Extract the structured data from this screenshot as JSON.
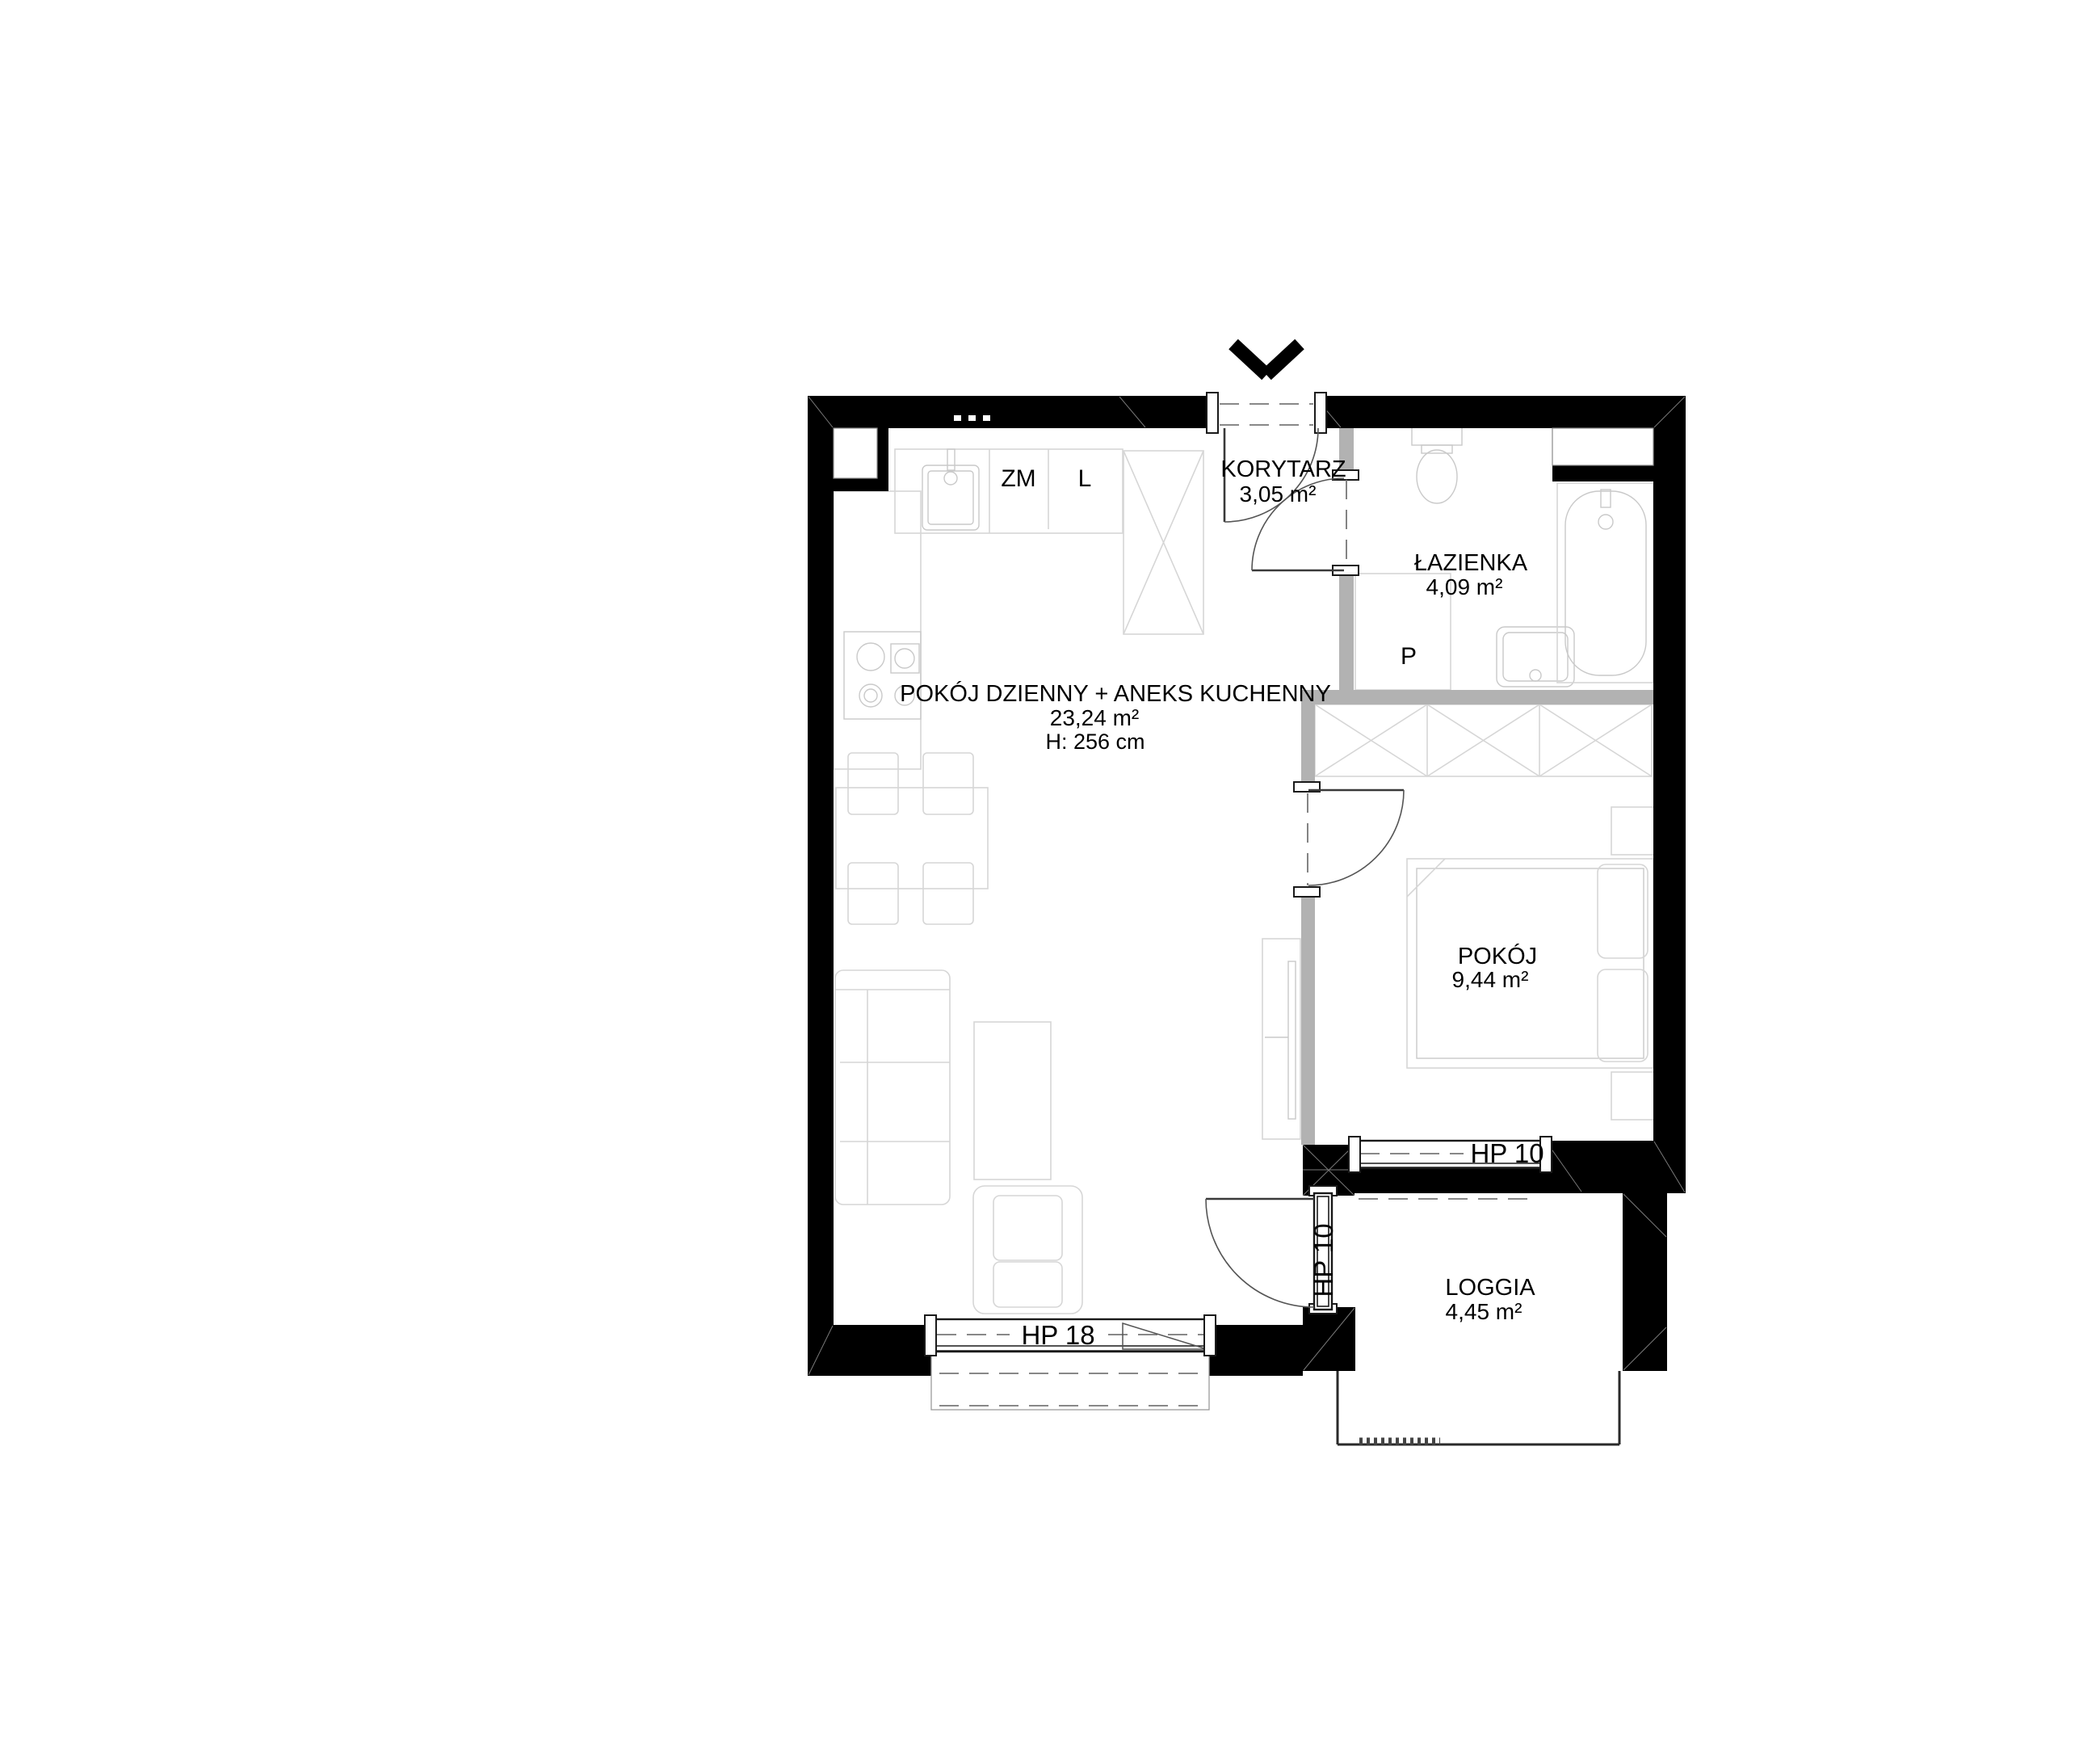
{
  "floorplan": {
    "rooms": [
      {
        "id": "living",
        "name": "POKÓJ DZIENNY + ANEKS KUCHENNY",
        "area": "23,24 m²",
        "height": "H: 256 cm"
      },
      {
        "id": "corridor",
        "name": "KORYTARZ",
        "area": "3,05 m²"
      },
      {
        "id": "bathroom",
        "name": "ŁAZIENKA",
        "area": "4,09 m²"
      },
      {
        "id": "bedroom",
        "name": "POKÓJ",
        "area": "9,44 m²"
      },
      {
        "id": "loggia",
        "name": "LOGGIA",
        "area": "4,45 m²"
      }
    ],
    "appliances": {
      "dishwasher": "ZM",
      "fridge": "L",
      "washing_machine": "P"
    },
    "windows": {
      "living_room_window": "HP 18",
      "balcony_door": "HP 10",
      "bedroom_window": "HP 10"
    },
    "colors": {
      "wall": "#000000",
      "partition": "#b2b2b2",
      "furniture_line": "#d6d6d6",
      "dashed_line": "#777777",
      "text": "#000000",
      "background": "#ffffff"
    }
  }
}
